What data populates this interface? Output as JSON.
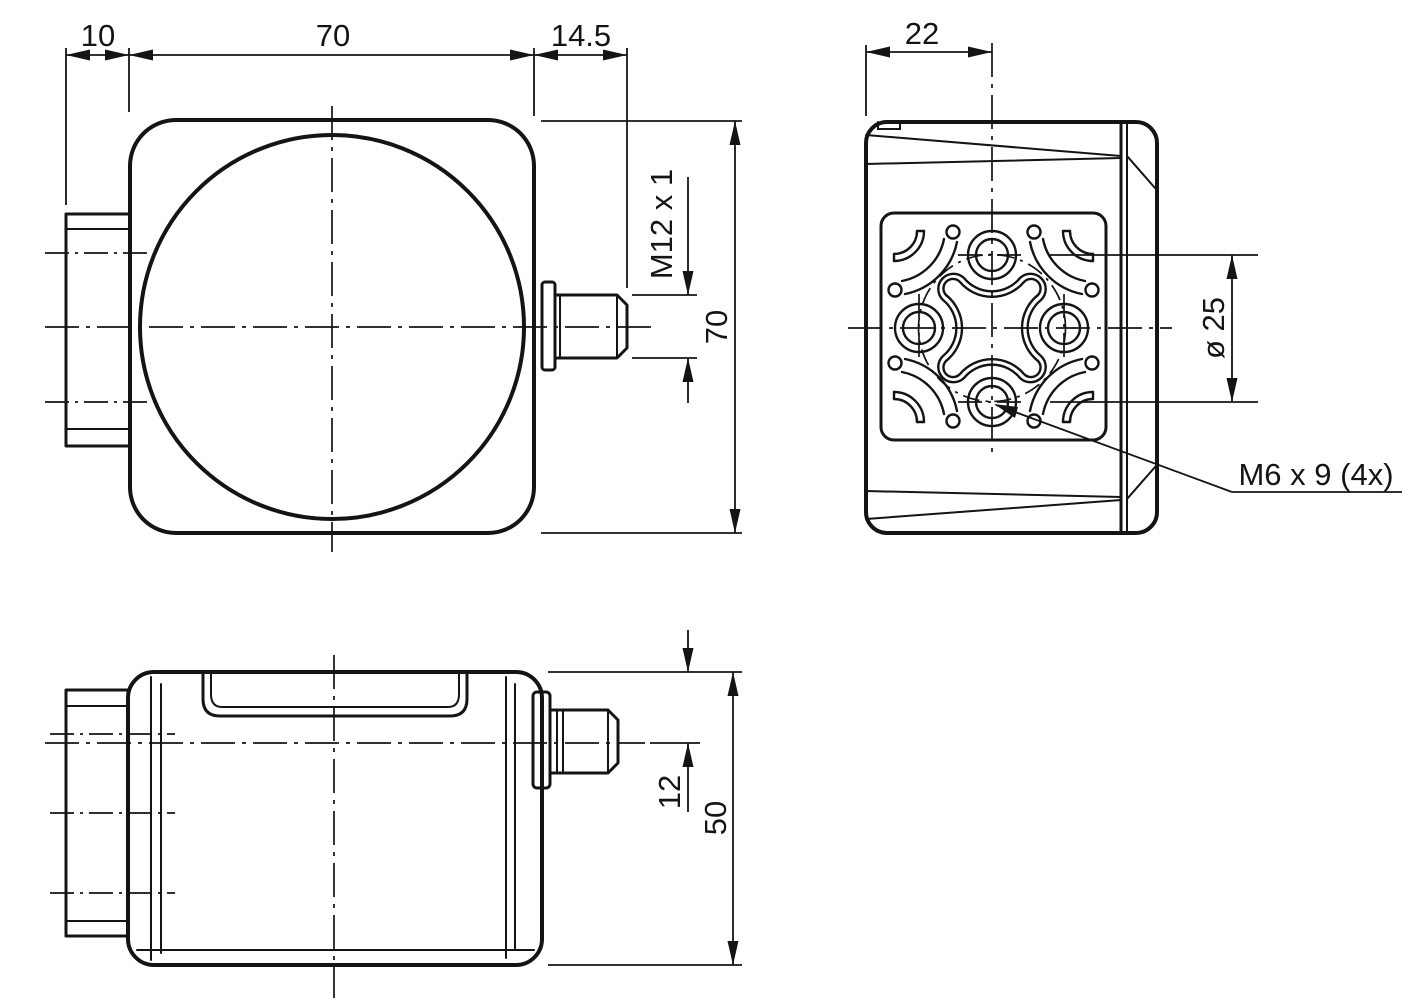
{
  "colors": {
    "line": "#141414",
    "background": "#ffffff"
  },
  "front_view": {
    "dim_block_depth": "10",
    "dim_body_width": "70",
    "dim_connector_length": "14.5",
    "dim_connector_thread": "M12 x 1",
    "dim_body_height": "70"
  },
  "rear_view": {
    "dim_face_to_center": "22",
    "dim_bolt_circle": "ø 25",
    "label_mounting_holes": "M6 x 9 (4x)"
  },
  "side_view": {
    "dim_axis_offset": "12",
    "dim_body_depth": "50"
  }
}
